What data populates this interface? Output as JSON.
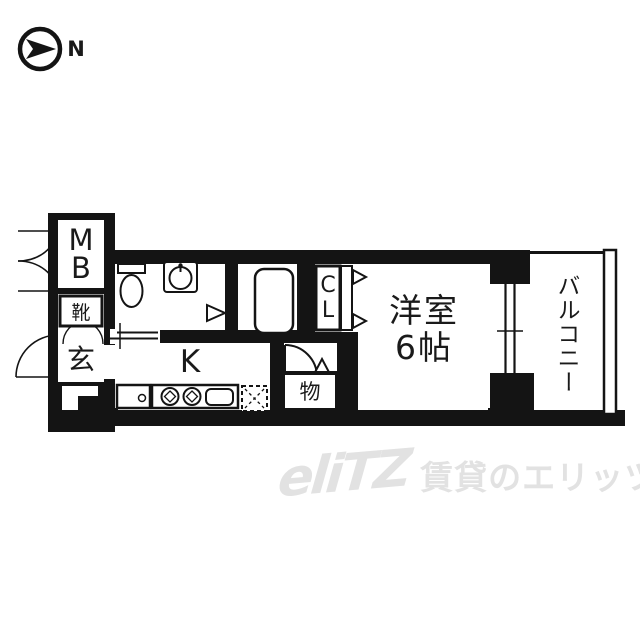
{
  "compass": {
    "label": "N"
  },
  "plan": {
    "meter_box": {
      "chars": [
        "M",
        "B"
      ]
    },
    "shoe_cabinet": {
      "label": "靴"
    },
    "entrance": {
      "label": "玄"
    },
    "kitchen": {
      "label": "K"
    },
    "storage": {
      "label": "物"
    },
    "closet": {
      "chars": [
        "C",
        "L"
      ]
    },
    "main_room": {
      "name": "洋室",
      "size": "6帖"
    },
    "balcony": {
      "label": "バルコニー"
    },
    "fixtures": [
      "toilet",
      "wash-basin",
      "bathtub",
      "stove-burners",
      "kitchen-sink",
      "refrigerator-space"
    ],
    "colors": {
      "wall": "#141414",
      "floor": "#ffffff"
    }
  },
  "watermark": {
    "logo": "eliTZ",
    "text": "賃貸のエリッツ",
    "color": "#e2e2e2"
  }
}
